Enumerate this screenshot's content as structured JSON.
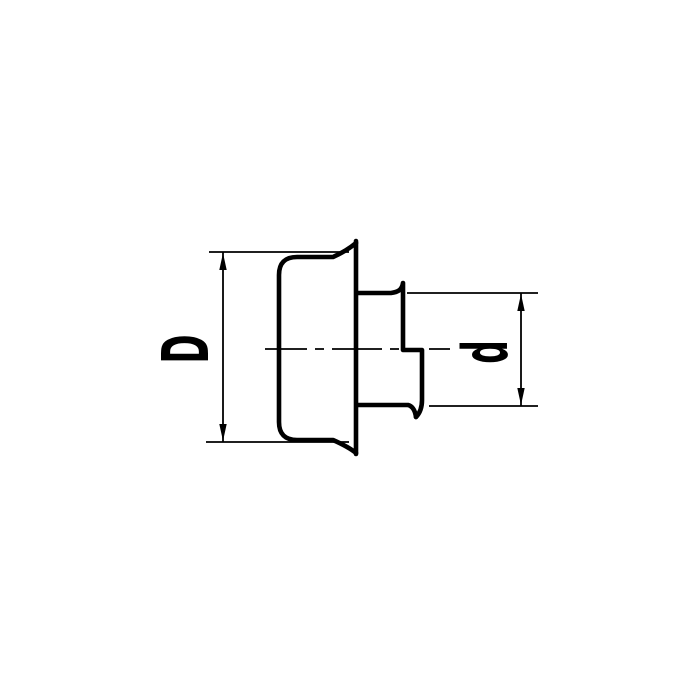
{
  "colors": {
    "background": "#ffffff",
    "line": "#000000"
  },
  "labels": {
    "large_diameter": "D",
    "small_diameter": "d"
  }
}
